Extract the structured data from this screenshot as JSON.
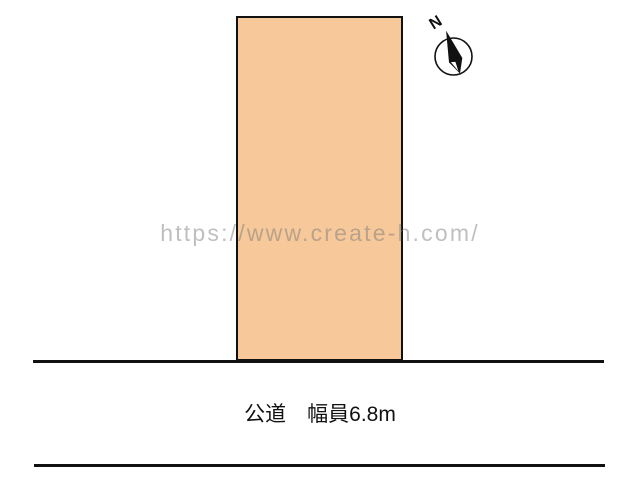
{
  "page": {
    "watermark": "https://www.create-h.com/",
    "compass": {
      "label": "N"
    },
    "road": {
      "label": "公道　幅員6.8m",
      "width_text": "6.8m",
      "type_text": "公道"
    },
    "colors": {
      "lot_fill": "#F6C89A",
      "outline": "#111111",
      "watermark_gray": "#C6C6C6",
      "background": "#FFFFFF"
    }
  }
}
